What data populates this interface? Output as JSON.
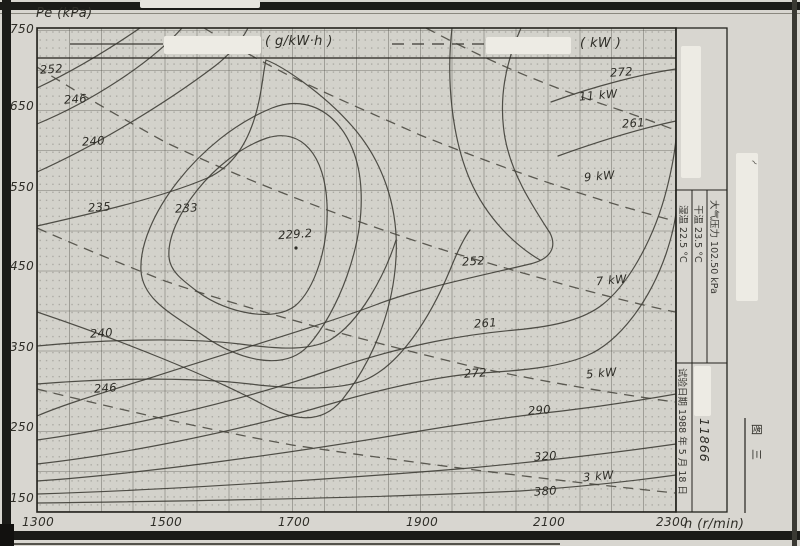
{
  "figure": {
    "caption": "图三"
  },
  "axes": {
    "y_title": "Pe (kPa)",
    "x_title": "n (r/min)",
    "y_ticks": [
      {
        "t": "750",
        "y": 22
      },
      {
        "t": "650",
        "y": 99
      },
      {
        "t": "550",
        "y": 180
      },
      {
        "t": "450",
        "y": 259
      },
      {
        "t": "350",
        "y": 340
      },
      {
        "t": "250",
        "y": 420
      },
      {
        "t": "150",
        "y": 491
      }
    ],
    "x_ticks": [
      {
        "t": "1300",
        "x": 22
      },
      {
        "t": "1500",
        "x": 150
      },
      {
        "t": "1700",
        "x": 278
      },
      {
        "t": "1900",
        "x": 406
      },
      {
        "t": "2100",
        "x": 533
      },
      {
        "t": "2300",
        "x": 656
      }
    ]
  },
  "legend": {
    "bsfc_unit": "( g/kW·h )",
    "power_unit": "( kW )"
  },
  "plot_labels": [
    {
      "t": "252",
      "x": 40,
      "y": 62,
      "k": "cl"
    },
    {
      "t": "246",
      "x": 64,
      "y": 92,
      "k": "cl"
    },
    {
      "t": "240",
      "x": 82,
      "y": 134,
      "k": "cl"
    },
    {
      "t": "235",
      "x": 88,
      "y": 200,
      "k": "cl"
    },
    {
      "t": "233",
      "x": 175,
      "y": 201,
      "k": "cl"
    },
    {
      "t": "229.2",
      "x": 278,
      "y": 227,
      "k": "cl"
    },
    {
      "t": "252",
      "x": 462,
      "y": 254,
      "k": "cl"
    },
    {
      "t": "261",
      "x": 474,
      "y": 316,
      "k": "cl"
    },
    {
      "t": "272",
      "x": 464,
      "y": 366,
      "k": "cl"
    },
    {
      "t": "290",
      "x": 528,
      "y": 403,
      "k": "cl"
    },
    {
      "t": "320",
      "x": 534,
      "y": 449,
      "k": "cl"
    },
    {
      "t": "380",
      "x": 534,
      "y": 484,
      "k": "cl"
    },
    {
      "t": "272",
      "x": 610,
      "y": 65,
      "k": "cl"
    },
    {
      "t": "261",
      "x": 622,
      "y": 116,
      "k": "cl"
    },
    {
      "t": "240",
      "x": 90,
      "y": 326,
      "k": "cl"
    },
    {
      "t": "246",
      "x": 94,
      "y": 381,
      "k": "cl"
    },
    {
      "t": "11 kW",
      "x": 579,
      "y": 88,
      "k": "pw"
    },
    {
      "t": "9 kW",
      "x": 584,
      "y": 169,
      "k": "pw"
    },
    {
      "t": "7 kW",
      "x": 596,
      "y": 273,
      "k": "pw"
    },
    {
      "t": "5 kW",
      "x": 586,
      "y": 366,
      "k": "pw"
    },
    {
      "t": "3 kW",
      "x": 583,
      "y": 469,
      "k": "pw"
    }
  ],
  "conditions": {
    "wet_temp": "湿温    22.5 °C",
    "dry_temp": "干温    23.5 °C",
    "atm_pressure": "大气压力  102.50 kPa",
    "test_date": "试验日期 1988 年 5 月 18 日",
    "serial_number": "11866",
    "margin_mark": "~"
  },
  "chart_data": {
    "type": "contour",
    "title": "Engine universal characteristic map (scan): BSFC contours with constant-power curves",
    "x": {
      "label": "n (r/min)",
      "range": [
        1300,
        2300
      ],
      "ticks": [
        1300,
        1500,
        1700,
        1900,
        2100,
        2300
      ]
    },
    "y": {
      "label": "Pe (kPa)",
      "range": [
        150,
        750
      ],
      "ticks": [
        750,
        650,
        550,
        450,
        350,
        250,
        150
      ]
    },
    "bsfc_contours_g_per_kWh": [
      229.2,
      233,
      235,
      240,
      246,
      252,
      261,
      272,
      290,
      320,
      380
    ],
    "min_point": {
      "bsfc_g_per_kWh": 229.2,
      "n_r_per_min": 1705,
      "pe_kPa": 476
    },
    "power_curves_kW": [
      3,
      5,
      7,
      9,
      11
    ],
    "legend": {
      "solid_lines": "( g/kW·h )",
      "dashed_lines": "( kW )"
    },
    "grid": true,
    "test_conditions": {
      "atmospheric_pressure": "102.50 kPa",
      "dry_bulb_temperature": "23.5 °C",
      "wet_bulb_temperature": "22.5 °C",
      "test_date": "1988-5-18",
      "serial": "11866"
    },
    "figure_number": "图三"
  }
}
